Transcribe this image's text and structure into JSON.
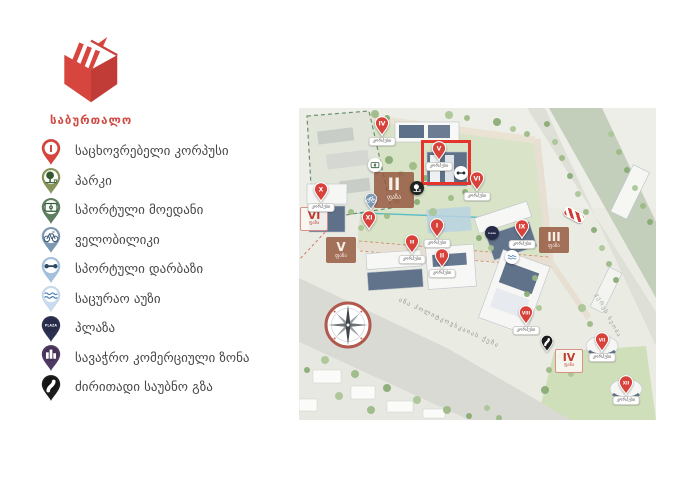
{
  "brand": {
    "title": "საბურთალო",
    "color": "#cf4b43"
  },
  "legend": {
    "items": [
      {
        "name": "residential",
        "label": "საცხოვრებელი კორპუსი",
        "pin_color": "#d8453e",
        "glyph": "numeral",
        "glyph_text": "I"
      },
      {
        "name": "park",
        "label": "პარკი",
        "pin_color": "#87955a",
        "glyph": "tree"
      },
      {
        "name": "sports-field",
        "label": "სპორტული მოედანი",
        "pin_color": "#5c7f5e",
        "glyph": "field"
      },
      {
        "name": "bike-path",
        "label": "ველობილიკი",
        "pin_color": "#7d98b3",
        "glyph": "bike"
      },
      {
        "name": "sports-hall",
        "label": "სპორტული დარბაზი",
        "pin_color": "#a3c1de",
        "glyph": "dumbbell"
      },
      {
        "name": "swimming-pool",
        "label": "საცურაო აუზი",
        "pin_color": "#c8dcf0",
        "glyph": "waves"
      },
      {
        "name": "plaza",
        "label": "პლაზა",
        "pin_color": "#2c3152",
        "glyph": "plaza",
        "glyph_text": "PLAZA"
      },
      {
        "name": "commercial-zone",
        "label": "სავაჭრო კომერციული ზონა",
        "pin_color": "#4e3a63",
        "glyph": "building"
      },
      {
        "name": "main-road",
        "label": "ძირითადი საუბნო გზა",
        "pin_color": "#1c1c1c",
        "glyph": "road"
      }
    ]
  },
  "map": {
    "street_label": "ანა პოლიტკოვსკაიას ქუჩა",
    "river_label": "ვერეს ხეობა",
    "phase_labels": [
      {
        "num": "II",
        "word": "ფაზა",
        "x": 95,
        "y": 82,
        "style": "brown",
        "size": "lg"
      },
      {
        "num": "III",
        "word": "ფაზა",
        "x": 255,
        "y": 132,
        "style": "brown",
        "size": ""
      },
      {
        "num": "V",
        "word": "ფაზა",
        "x": 42,
        "y": 142,
        "style": "brown",
        "size": ""
      },
      {
        "num": "VI",
        "word": "ფაზა",
        "x": 15,
        "y": 111,
        "style": "light",
        "size": ""
      },
      {
        "num": "IV",
        "word": "ფაზა",
        "x": 270,
        "y": 253,
        "style": "light",
        "size": ""
      }
    ],
    "building_pins": [
      {
        "num": "IV",
        "x": 83,
        "y": 20,
        "pill": "კორპუსი"
      },
      {
        "num": "V",
        "x": 140,
        "y": 45,
        "pill": "კორპუსი"
      },
      {
        "num": "VI",
        "x": 178,
        "y": 75,
        "pill": "კორპუსი"
      },
      {
        "num": "X",
        "x": 22,
        "y": 86,
        "pill": "კორპუსი"
      },
      {
        "num": "XI",
        "x": 70,
        "y": 114,
        "pill": ""
      },
      {
        "num": "I",
        "x": 138,
        "y": 122,
        "pill": "კორპუსი"
      },
      {
        "num": "III",
        "x": 113,
        "y": 138,
        "pill": "კორპუსი"
      },
      {
        "num": "II",
        "x": 143,
        "y": 152,
        "pill": "კორპუსი"
      },
      {
        "num": "IX",
        "x": 223,
        "y": 123,
        "pill": "კორპუსი"
      },
      {
        "num": "VIII",
        "x": 227,
        "y": 209,
        "pill": "კორპუსი"
      },
      {
        "num": "VII",
        "x": 303,
        "y": 236,
        "pill": "კორპუსი"
      },
      {
        "num": "XII",
        "x": 327,
        "y": 279,
        "pill": "კორპუსი"
      }
    ],
    "amenities": [
      {
        "type": "sports-field",
        "x": 76,
        "y": 57
      },
      {
        "type": "sports-hall",
        "x": 162,
        "y": 65
      },
      {
        "type": "park",
        "x": 118,
        "y": 80
      },
      {
        "type": "bike-path",
        "x": 72,
        "y": 97
      },
      {
        "type": "plaza",
        "x": 193,
        "y": 125
      },
      {
        "type": "swimming-pool",
        "x": 213,
        "y": 149
      },
      {
        "type": "main-road",
        "x": 248,
        "y": 239
      },
      {
        "type": "road-sign",
        "x": 275,
        "y": 107
      }
    ],
    "highlight": {
      "x": 122,
      "y": 32,
      "w": 50,
      "h": 45
    }
  }
}
